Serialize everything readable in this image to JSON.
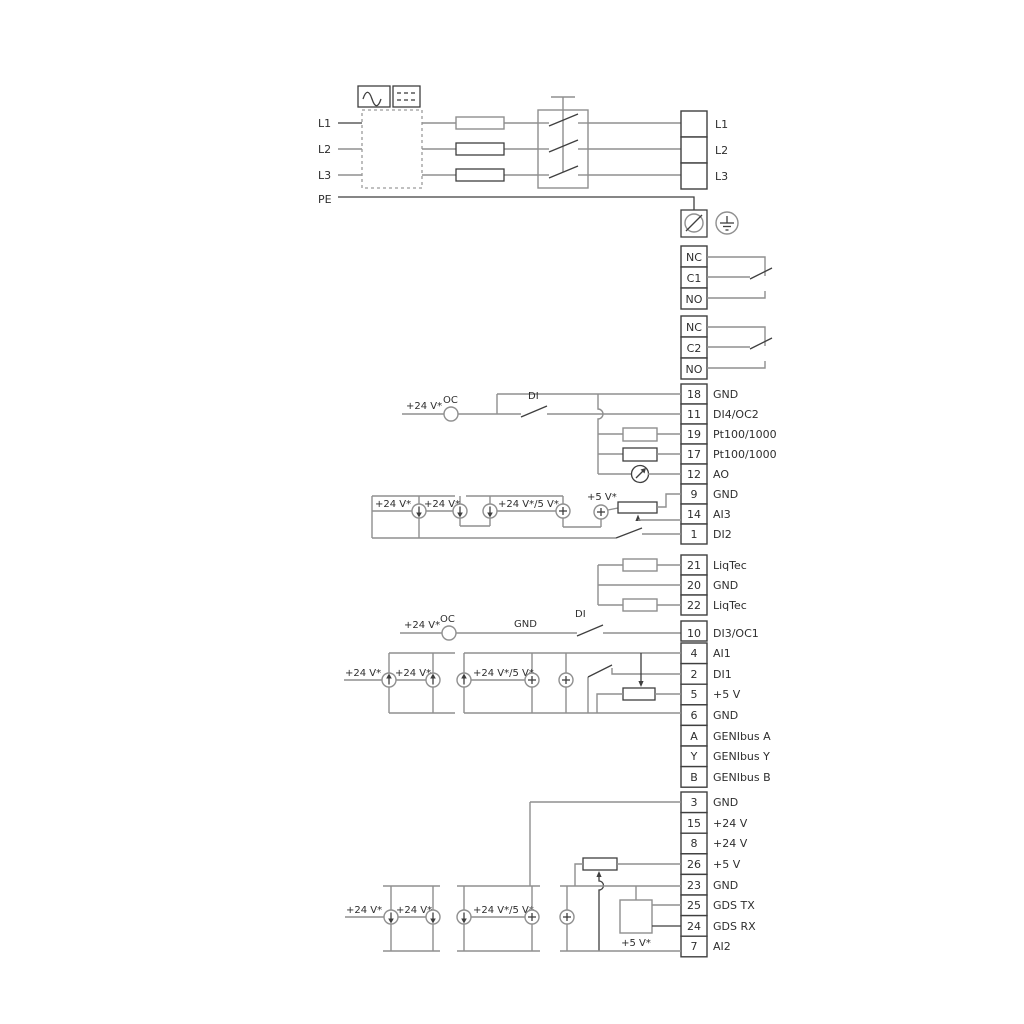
{
  "power": {
    "inputs": [
      "L1",
      "L2",
      "L3",
      "PE"
    ],
    "outputs": [
      "L1",
      "L2",
      "L3"
    ]
  },
  "relay1": {
    "rows": [
      "NC",
      "C1",
      "NO"
    ]
  },
  "relay2": {
    "rows": [
      "NC",
      "C2",
      "NO"
    ]
  },
  "strip1": [
    {
      "num": "18",
      "label": "GND"
    },
    {
      "num": "11",
      "label": "DI4/OC2"
    },
    {
      "num": "19",
      "label": "Pt100/1000"
    },
    {
      "num": "17",
      "label": "Pt100/1000"
    },
    {
      "num": "12",
      "label": "AO"
    },
    {
      "num": "9",
      "label": "GND"
    },
    {
      "num": "14",
      "label": "AI3"
    },
    {
      "num": "1",
      "label": "DI2"
    }
  ],
  "liqtec": [
    {
      "num": "21",
      "label": "LiqTec"
    },
    {
      "num": "20",
      "label": "GND"
    },
    {
      "num": "22",
      "label": "LiqTec"
    }
  ],
  "strip2": [
    {
      "num": "10",
      "label": "DI3/OC1"
    },
    {
      "num": "4",
      "label": "AI1"
    },
    {
      "num": "2",
      "label": "DI1"
    },
    {
      "num": "5",
      "label": "+5 V"
    },
    {
      "num": "6",
      "label": "GND"
    },
    {
      "num": "A",
      "label": "GENIbus A"
    },
    {
      "num": "Y",
      "label": "GENIbus Y"
    },
    {
      "num": "B",
      "label": "GENIbus B"
    }
  ],
  "strip3": [
    {
      "num": "3",
      "label": "GND"
    },
    {
      "num": "15",
      "label": "+24 V"
    },
    {
      "num": "8",
      "label": "+24 V"
    },
    {
      "num": "26",
      "label": "+5 V"
    },
    {
      "num": "23",
      "label": "GND"
    },
    {
      "num": "25",
      "label": "GDS TX"
    },
    {
      "num": "24",
      "label": "GDS RX"
    },
    {
      "num": "7",
      "label": "AI2"
    }
  ],
  "annotations": {
    "v24": "+24 V*",
    "v24or5": "+24 V*/5 V*",
    "v5": "+5 V*",
    "oc": "OC",
    "di": "DI",
    "gnd": "GND"
  },
  "colors": {
    "wire_gray": "#8f8f8f",
    "wire_dark": "#3f3f3f",
    "text": "#2e2e2e",
    "background": "#ffffff"
  }
}
